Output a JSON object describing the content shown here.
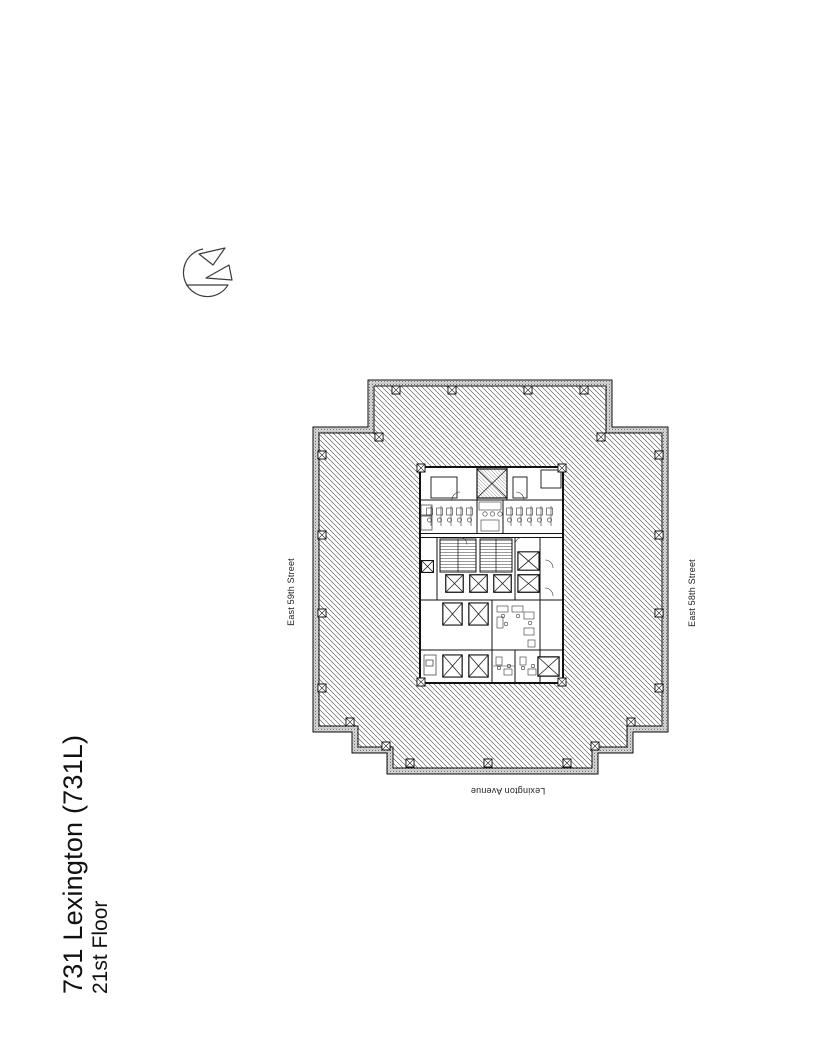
{
  "sheet": {
    "background_color": "#ffffff",
    "line_color": "#1a1a1a"
  },
  "title_block": {
    "line1": "731 Lexington (731L)",
    "line2": "21st Floor"
  },
  "streets": {
    "west": "East 59th Street",
    "east": "East 58th Street",
    "south": "Lexington Avenue"
  },
  "north_arrow": {
    "icon": "north-arrow"
  },
  "floor_plan": {
    "type": "architectural floor plate, stepped rectangular outline",
    "tenant_area_fill": "diagonal-hatch",
    "core": {
      "shaft_boxes": 12,
      "stair_shafts": 2,
      "restroom_stalls_left": 5,
      "restroom_stalls_right": 5
    },
    "perimeter_columns": 21
  }
}
